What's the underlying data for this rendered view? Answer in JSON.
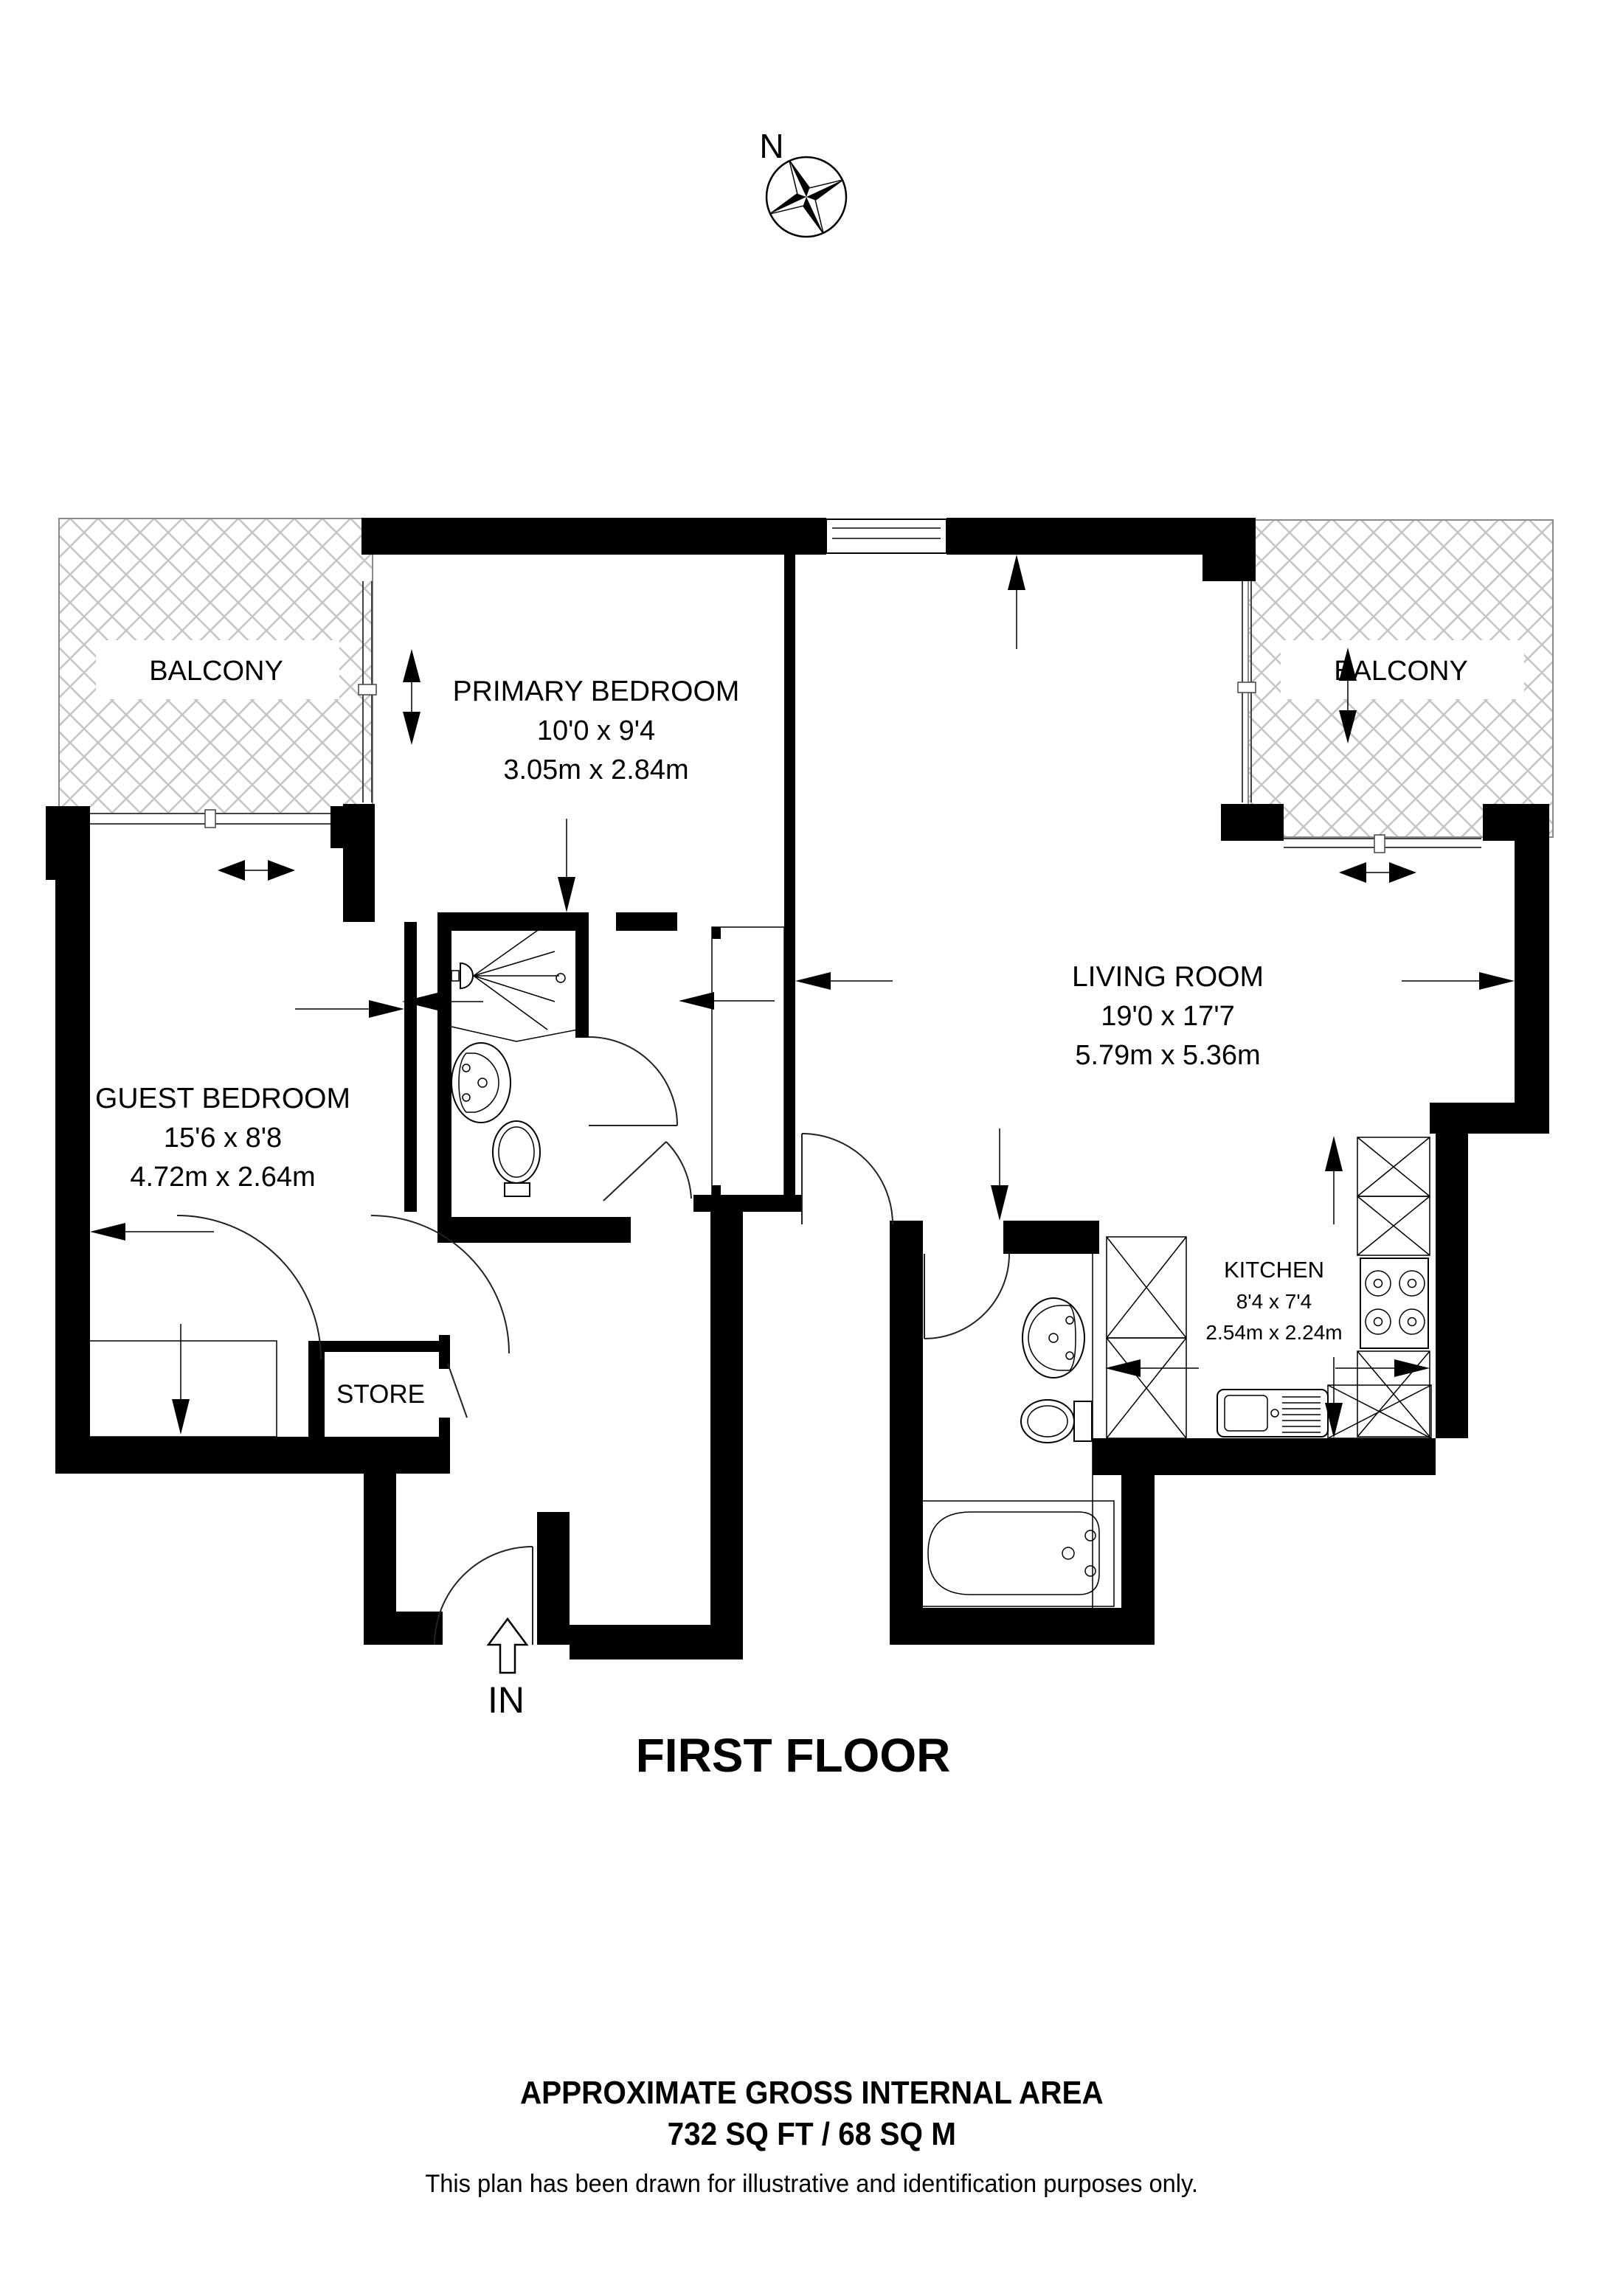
{
  "compass": {
    "north_label": "N"
  },
  "rooms": {
    "primary_bedroom": {
      "name": "PRIMARY BEDROOM",
      "imperial": "10'0 x 9'4",
      "metric": "3.05m x 2.84m"
    },
    "living_room": {
      "name": "LIVING ROOM",
      "imperial": "19'0 x 17'7",
      "metric": "5.79m x 5.36m"
    },
    "guest_bedroom": {
      "name": "GUEST BEDROOM",
      "imperial": "15'6 x 8'8",
      "metric": "4.72m x 2.64m"
    },
    "kitchen": {
      "name": "KITCHEN",
      "imperial": "8'4 x 7'4",
      "metric": "2.54m x 2.24m"
    },
    "store": {
      "name": "STORE"
    },
    "balcony_left": {
      "name": "BALCONY"
    },
    "balcony_right": {
      "name": "BALCONY"
    }
  },
  "entry": {
    "label": "IN"
  },
  "floor": {
    "title": "FIRST FLOOR"
  },
  "footer": {
    "area_title": "APPROXIMATE GROSS INTERNAL AREA",
    "area_value": "732 SQ FT / 68 SQ M",
    "disclaimer": "This plan has been drawn for illustrative and identification purposes only."
  },
  "colors": {
    "wall": "#000000",
    "hatch": "#c4c4c4",
    "background": "#ffffff"
  }
}
